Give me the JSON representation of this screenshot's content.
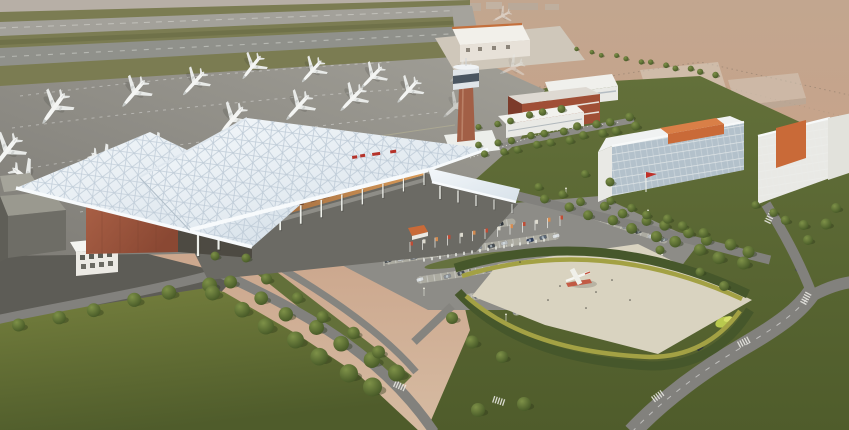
{
  "meta": {
    "title": "Aerial rendering of an airport terminal complex",
    "type": "architectural-rendering",
    "canvas": {
      "width": 849,
      "height": 430
    }
  },
  "scene": {
    "description": "Bird's-eye 3D rendering: white space-frame terminal canopy with brick wing, control tower, apron with parked white airliners, runway and taxiways top-left, hazy terrain top-right, office/hotel slabs with orange roof blocks, tree-lined roads, car park with flag row, landscaped plaza with airplane monument, large lawns.",
    "elements": [
      "runway",
      "taxiway",
      "apron",
      "airliners",
      "terminal-canopy",
      "terminal-brick-wing",
      "colonnade",
      "control-tower",
      "cargo-building",
      "office-buildings",
      "parking-lot",
      "flag-row",
      "balustrade",
      "plaza",
      "airplane-monument",
      "hedge-bands",
      "lawns",
      "tree-rows",
      "roads",
      "crosswalks"
    ]
  },
  "colors": {
    "haze_top": "#c2a68f",
    "haze_mid": "#c9a288",
    "haze_low": "#d6bba2",
    "wash": "#b6b0a8",
    "runway": "#a3a19a",
    "taxiway": "#90918b",
    "grass_strip": "#7b7c52",
    "grass_strip2": "#6f7149",
    "apron_light": "#a19f97",
    "apron_dark": "#7f7d77",
    "marking": "#e9ece9",
    "roof_hi": "#f3f7fa",
    "roof_lo": "#d8e2ea",
    "roof_grid": "#b7c5d2",
    "fascia": "#f7fafc",
    "column": "#edefe9",
    "interior_hi": "#d89a58",
    "interior_lo": "#8a5936",
    "interior_dark": "#6a4128",
    "brick_hi": "#a85f45",
    "brick_lo": "#8a4833",
    "tower_brick": "#a25f46",
    "tower_cab": "#dfe4e8",
    "tower_band": "#4a5560",
    "bldg_white": "#e9e9e5",
    "bldg_shade": "#cbccc6",
    "glass": "#b3c1cb",
    "win_line": "#eef0ee",
    "orange": "#c96a38",
    "orange_hi": "#d97f47",
    "red_brick": "#a04f36",
    "red_brick_dark": "#7c3b2a",
    "sign_red": "#b5332a",
    "flag_red": "#c03028",
    "road": "#82817d",
    "road_dark": "#5d5c56",
    "ground_shadow": "#6b6a64",
    "curb": "#d5d5cf",
    "lot": "#8d8c87",
    "stall_band": "#b4b3a8",
    "lawn_light": "#76803e",
    "lawn_dark": "#4f5c2b",
    "lawn_mid": "#63703a",
    "tree_light": "#7e9148",
    "tree_dark": "#3b4d20",
    "tree_shadow": "#2c3a1a",
    "hedge_dark": "#46572b",
    "hedge_yellow": "#a3a144",
    "plaza": "#d9d3c0",
    "pad": "#cfc7ba",
    "plane_white": "#f4f5f3",
    "lime_shrub": "#b9c94e"
  },
  "planes": {
    "note": "x,y,scale,rotation,opacity; rotation 0 = nose north",
    "apron": [
      [
        6,
        152,
        0.72,
        218,
        1
      ],
      [
        54,
        108,
        0.7,
        216,
        1
      ],
      [
        134,
        93,
        0.64,
        220,
        1
      ],
      [
        194,
        83,
        0.58,
        222,
        1
      ],
      [
        252,
        67,
        0.54,
        218,
        1
      ],
      [
        312,
        71,
        0.54,
        222,
        1
      ],
      [
        372,
        77,
        0.55,
        224,
        1
      ],
      [
        232,
        120,
        0.66,
        220,
        1
      ],
      [
        298,
        107,
        0.62,
        222,
        1
      ],
      [
        352,
        99,
        0.59,
        224,
        1
      ],
      [
        408,
        91,
        0.56,
        222,
        1
      ],
      [
        455,
        107,
        0.55,
        228,
        0.55
      ],
      [
        462,
        74,
        0.5,
        238,
        0.5
      ],
      [
        512,
        68,
        0.48,
        244,
        0.42
      ],
      [
        502,
        16,
        0.36,
        242,
        0.5
      ]
    ],
    "docked": [
      [
        28,
        180,
        0.76,
        128,
        1
      ],
      [
        106,
        164,
        0.7,
        127,
        1
      ],
      [
        158,
        150,
        0.62,
        126,
        1
      ]
    ]
  },
  "trees": {
    "rows": [
      [
        578,
        50,
        714,
        74,
        12,
        2.2,
        3.2
      ],
      [
        20,
        326,
        208,
        284,
        6,
        6.5,
        7.5
      ],
      [
        232,
        283,
        398,
        374,
        7,
        6.5,
        8.5
      ],
      [
        214,
        294,
        374,
        388,
        7,
        7.5,
        9.5
      ],
      [
        268,
        280,
        380,
        352,
        5,
        5.5,
        6.5
      ],
      [
        480,
        146,
        628,
        118,
        10,
        3.4,
        4.4
      ],
      [
        486,
        155,
        634,
        127,
        10,
        3.6,
        4.6
      ],
      [
        540,
        188,
        750,
        252,
        11,
        4,
        6
      ],
      [
        546,
        200,
        742,
        264,
        10,
        4.5,
        6.5
      ],
      [
        612,
        202,
        702,
        232,
        6,
        4,
        5
      ],
      [
        757,
        206,
        802,
        226,
        4,
        4,
        5
      ],
      [
        480,
        128,
        560,
        108,
        6,
        3,
        4
      ]
    ],
    "singles": [
      [
        452,
        318,
        6
      ],
      [
        472,
        342,
        6.5
      ],
      [
        502,
        357,
        6
      ],
      [
        524,
        404,
        7
      ],
      [
        478,
        410,
        7
      ],
      [
        836,
        208,
        5
      ],
      [
        826,
        224,
        5.5
      ],
      [
        808,
        240,
        5
      ],
      [
        246,
        258,
        4.5
      ],
      [
        215,
        256,
        4.5
      ],
      [
        724,
        286,
        5
      ],
      [
        700,
        272,
        4.5
      ],
      [
        660,
        250,
        4.5
      ],
      [
        585,
        174,
        4
      ],
      [
        610,
        182,
        4.5
      ]
    ]
  },
  "cars": {
    "angle": -16,
    "palette": [
      "#30363c",
      "#d7dadb",
      "#5b6673",
      "#2e3d5c",
      "#777d82",
      "#b9bdbf",
      "#464c52",
      "#8d9298"
    ],
    "rows": [
      [
        352,
        226,
        470,
        208,
        11
      ],
      [
        368,
        243,
        512,
        222,
        13
      ],
      [
        388,
        261,
        556,
        236,
        14
      ],
      [
        420,
        280,
        598,
        253,
        14
      ],
      [
        464,
        298,
        630,
        273,
        13
      ],
      [
        516,
        312,
        652,
        291,
        11
      ],
      [
        588,
        214,
        664,
        240,
        7
      ]
    ],
    "road_cars": [
      [
        700,
        348,
        -35,
        0
      ],
      [
        762,
        330,
        -28,
        3
      ],
      [
        798,
        268,
        -62,
        6
      ],
      [
        540,
        300,
        -12,
        1
      ]
    ]
  },
  "flags": {
    "row": [
      410,
      252,
      560,
      226,
      13
    ],
    "banner_colors": [
      "#c24a32",
      "#e4e0d4",
      "#d98c4e"
    ]
  },
  "balustrade": [
    424,
    260,
    544,
    240,
    16
  ],
  "lamps": [
    [
      348,
      236
    ],
    [
      384,
      266
    ],
    [
      424,
      296
    ],
    [
      506,
      322
    ],
    [
      602,
      304
    ],
    [
      662,
      262
    ],
    [
      648,
      218
    ],
    [
      566,
      196
    ],
    [
      306,
      262
    ]
  ],
  "crosswalks": [
    [
      400,
      386,
      24
    ],
    [
      658,
      396,
      -36
    ],
    [
      744,
      342,
      -28
    ],
    [
      806,
      298,
      -62
    ],
    [
      770,
      217,
      -64
    ],
    [
      499,
      401,
      18
    ]
  ],
  "people_dots": [
    [
      560,
      286
    ],
    [
      596,
      292
    ],
    [
      612,
      280
    ],
    [
      548,
      300
    ],
    [
      630,
      300
    ],
    [
      586,
      308
    ],
    [
      470,
      270
    ],
    [
      520,
      262
    ]
  ],
  "colonnades": [
    [
      424,
      173,
      198,
      232,
      12,
      12,
      24,
      1.1,
      2.2
    ],
    [
      512,
      204,
      440,
      186,
      5,
      9,
      13,
      0.9,
      1.4
    ]
  ],
  "medians": [
    [
      418,
      234,
      38,
      4.5
    ],
    [
      472,
      260,
      48,
      5
    ],
    [
      540,
      288,
      48,
      5
    ]
  ]
}
